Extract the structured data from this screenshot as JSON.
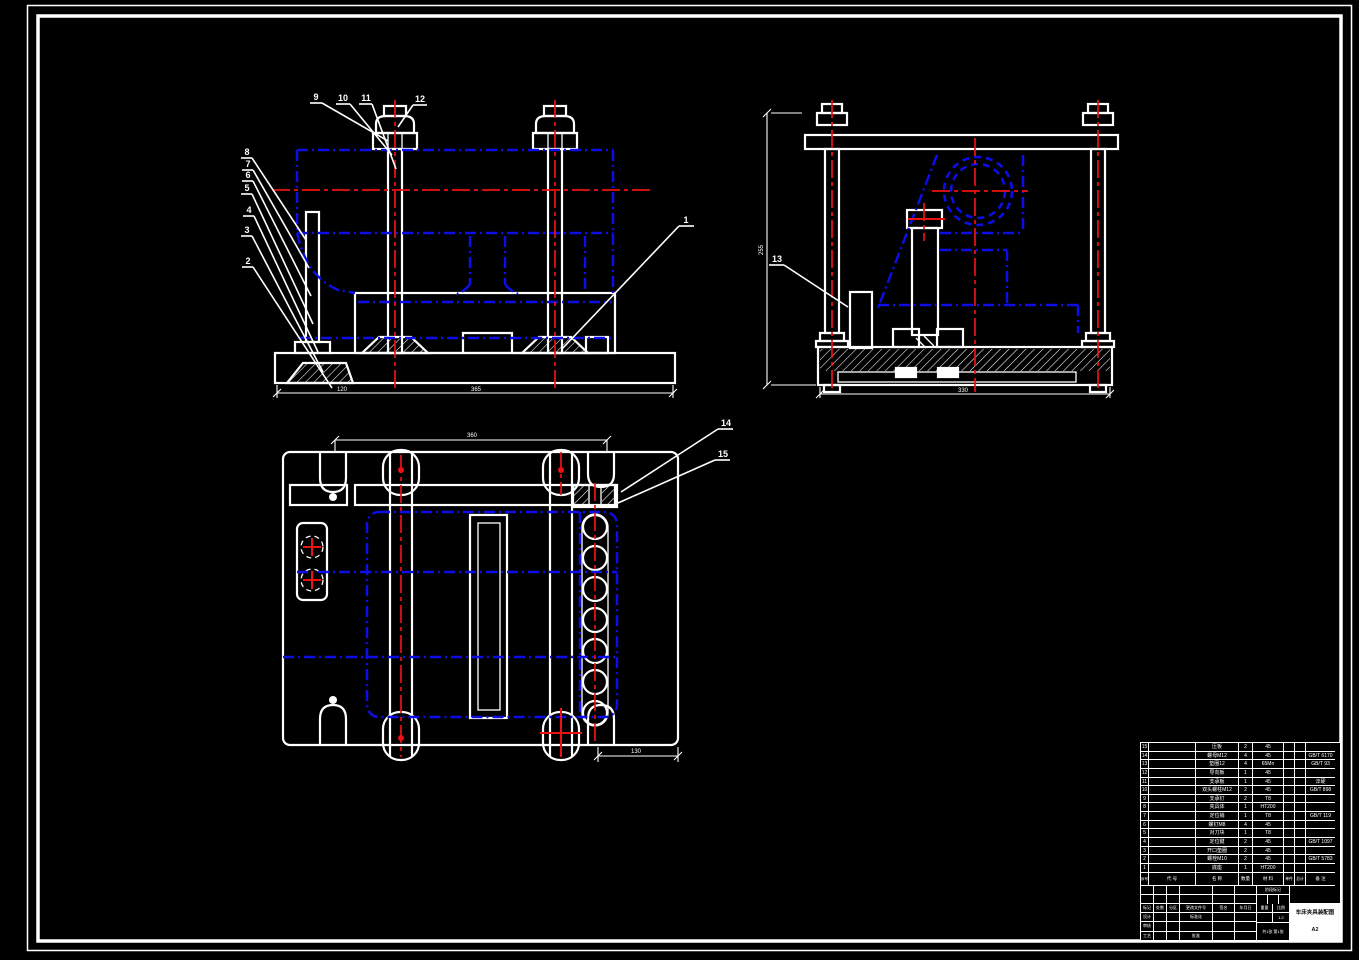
{
  "sheet": {
    "background": "#000000",
    "line_color": "#ffffff",
    "hidden_line_color": "#0d0de8",
    "centerline_color": "#ee1111"
  },
  "callouts": {
    "front_top": [
      "9",
      "10",
      "11",
      "12"
    ],
    "front_left": [
      "8",
      "7",
      "6",
      "5",
      "4",
      "3",
      "2"
    ],
    "front_right": [
      "1"
    ],
    "side": [
      "13"
    ],
    "plan": [
      "14",
      "15"
    ]
  },
  "dimensions": {
    "front_a": "120",
    "front_b": "365",
    "side_h": "255",
    "side_w": "330",
    "plan_w": "360",
    "plan_b": "130"
  },
  "bom": {
    "col_keys": [
      "no",
      "code",
      "name",
      "qty",
      "material",
      "unit",
      "total",
      "remark"
    ],
    "headers": {
      "no": "序号",
      "code": "代  号",
      "name": "名  称",
      "qty": "数量",
      "material": "材  料",
      "unit": "单件",
      "total": "总计",
      "remark": "备  注"
    },
    "rows": [
      {
        "no": "15",
        "code": "",
        "name": "压板",
        "qty": "2",
        "material": "45",
        "unit": "",
        "total": "",
        "remark": ""
      },
      {
        "no": "14",
        "code": "",
        "name": "螺母M12",
        "qty": "4",
        "material": "45",
        "unit": "",
        "total": "",
        "remark": "GB/T 6170"
      },
      {
        "no": "13",
        "code": "",
        "name": "垫圈12",
        "qty": "4",
        "material": "65Mn",
        "unit": "",
        "total": "",
        "remark": "GB/T 93"
      },
      {
        "no": "12",
        "code": "",
        "name": "导向板",
        "qty": "1",
        "material": "45",
        "unit": "",
        "total": "",
        "remark": ""
      },
      {
        "no": "11",
        "code": "",
        "name": "支承板",
        "qty": "1",
        "material": "45",
        "unit": "",
        "total": "",
        "remark": "淬硬"
      },
      {
        "no": "10",
        "code": "",
        "name": "双头螺柱M12",
        "qty": "2",
        "material": "45",
        "unit": "",
        "total": "",
        "remark": "GB/T 898"
      },
      {
        "no": "9",
        "code": "",
        "name": "支承钉",
        "qty": "2",
        "material": "T8",
        "unit": "",
        "total": "",
        "remark": ""
      },
      {
        "no": "8",
        "code": "",
        "name": "夹具体",
        "qty": "1",
        "material": "HT200",
        "unit": "",
        "total": "",
        "remark": ""
      },
      {
        "no": "7",
        "code": "",
        "name": "定位销",
        "qty": "1",
        "material": "T8",
        "unit": "",
        "total": "",
        "remark": "GB/T 119"
      },
      {
        "no": "6",
        "code": "",
        "name": "螺钉M8",
        "qty": "4",
        "material": "45",
        "unit": "",
        "total": "",
        "remark": ""
      },
      {
        "no": "5",
        "code": "",
        "name": "对刀块",
        "qty": "1",
        "material": "T8",
        "unit": "",
        "total": "",
        "remark": ""
      },
      {
        "no": "4",
        "code": "",
        "name": "定位键",
        "qty": "2",
        "material": "45",
        "unit": "",
        "total": "",
        "remark": "GB/T 1097"
      },
      {
        "no": "3",
        "code": "",
        "name": "开口垫圈",
        "qty": "2",
        "material": "45",
        "unit": "",
        "total": "",
        "remark": ""
      },
      {
        "no": "2",
        "code": "",
        "name": "螺栓M10",
        "qty": "2",
        "material": "45",
        "unit": "",
        "total": "",
        "remark": "GB/T 5783"
      },
      {
        "no": "1",
        "code": "",
        "name": "底座",
        "qty": "1",
        "material": "HT200",
        "unit": "",
        "total": "",
        "remark": ""
      }
    ]
  },
  "title_block": {
    "title": "车床夹具装配图",
    "rev_header": [
      "标记",
      "处数",
      "分区",
      "更改文件号",
      "签名",
      "年月日"
    ],
    "role_design": "设计",
    "role_check": "审核",
    "role_process": "工艺",
    "role_standard": "标准化",
    "role_approve": "批准",
    "stage_label": "阶段标记",
    "weight_label": "重量",
    "scale_label": "比例",
    "scale_value": "1:2",
    "sheet_info": "共1张 第1张",
    "sheet_size": "A2"
  }
}
